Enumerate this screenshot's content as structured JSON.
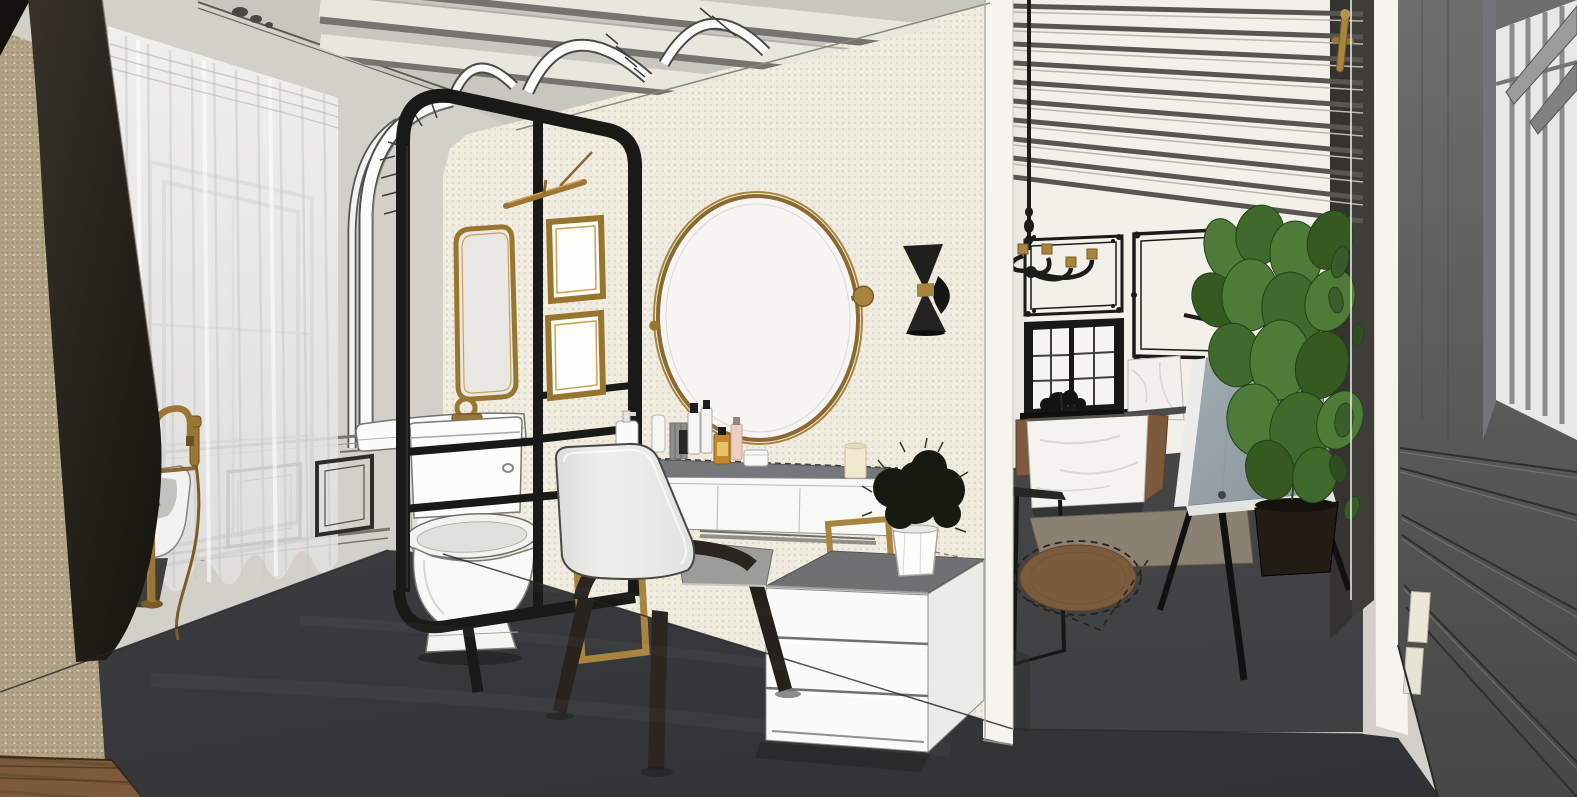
{
  "meta": {
    "image_type": "3d-interior-render",
    "render_style": "sketchup-style line render with textured shading",
    "view": "interior perspective of a bathroom vanity suite opening to an adjacent room",
    "canvas": {
      "width": 1577,
      "height": 797
    },
    "visible_text": "none"
  },
  "palette": {
    "ceiling": "#c9c6bf",
    "left_wall": "#d3d0c9",
    "cream_wall": "#f0ebdf",
    "tan_wall": "#b1a489",
    "jamb_white": "#f6f4ee",
    "right_room_wall": "#f2f0e9",
    "floor": "#3d3f42",
    "floor_right": "#46484a",
    "wood_floor": "#7b5b3b",
    "black_metal": "#191917",
    "brass": "#a8853e",
    "brass_dark": "#7a5a24",
    "fixture_white": "#fbfbf9",
    "furniture_top_gray": "#75777a",
    "chair_fabric": "#e7e7e4",
    "chair_wood": "#2b2520",
    "marble": "#f4f3f0",
    "cabinet_wood": "#7d5a3c",
    "plant_green": "#4e7c38",
    "plant_dark_green": "#35591f",
    "display_panel": "#97a1a8",
    "right_wall_gray": "#5f5f5d",
    "rug_brown": "#7a5c3d",
    "mat_tan": "#8b8172",
    "curtain": "#f2f2f0"
  },
  "scene": {
    "rooms": [
      {
        "name": "bathroom-vanity-room",
        "objects": [
          {
            "label": "window with sheer white curtain"
          },
          {
            "label": "ornate cornice molding"
          },
          {
            "label": "cream beam ceiling with white arched ribs"
          },
          {
            "label": "wainscot picture-frame panels"
          },
          {
            "label": "dark robe hanging at left wall"
          },
          {
            "label": "freestanding white bathtub"
          },
          {
            "label": "brass floor-mounted tub filler with hand shower"
          },
          {
            "label": "black steel partition frame with rounded corners"
          },
          {
            "label": "white pedestal console sink with brass loop faucet"
          },
          {
            "label": "white two-piece toilet"
          },
          {
            "label": "brass rectangular wall mirror"
          },
          {
            "label": "two brass picture frames on partition"
          },
          {
            "label": "brass picture light"
          },
          {
            "label": "round brass pivot mirror"
          },
          {
            "label": "black double-cone wall sconce with brass band"
          },
          {
            "label": "white vanity desk with gray top and brass frame legs"
          },
          {
            "label": "cosmetic bottles, jars and tubes"
          },
          {
            "label": "pillar candle"
          },
          {
            "label": "light upholstered chair with dark wood legs"
          },
          {
            "label": "white three-drawer chest with gray top"
          },
          {
            "label": "small plant in white faceted pot"
          }
        ]
      },
      {
        "name": "adjacent-room-through-opening",
        "objects": [
          {
            "label": "white slatted beam ceiling"
          },
          {
            "label": "black ornate baroque wall frames"
          },
          {
            "label": "black chandelier with brass candle cups"
          },
          {
            "label": "black framed interior window with grid panes"
          },
          {
            "label": "marble counter and island with wood cabinets"
          },
          {
            "label": "black metal console frame"
          },
          {
            "label": "flat sisal mat"
          },
          {
            "label": "round brown rug with dashed guide outline"
          },
          {
            "label": "gray display panel on black tripod stand"
          },
          {
            "label": "fiddle-leaf fig plant in dark pot"
          }
        ]
      },
      {
        "name": "right-foreground-wall",
        "objects": [
          {
            "label": "dark paneled wall receding in perspective"
          },
          {
            "label": "glass partition strips with brass handle"
          },
          {
            "label": "tall window with vertical panes and gray ledges"
          },
          {
            "label": "small cream panels on dark wall"
          }
        ]
      }
    ]
  }
}
